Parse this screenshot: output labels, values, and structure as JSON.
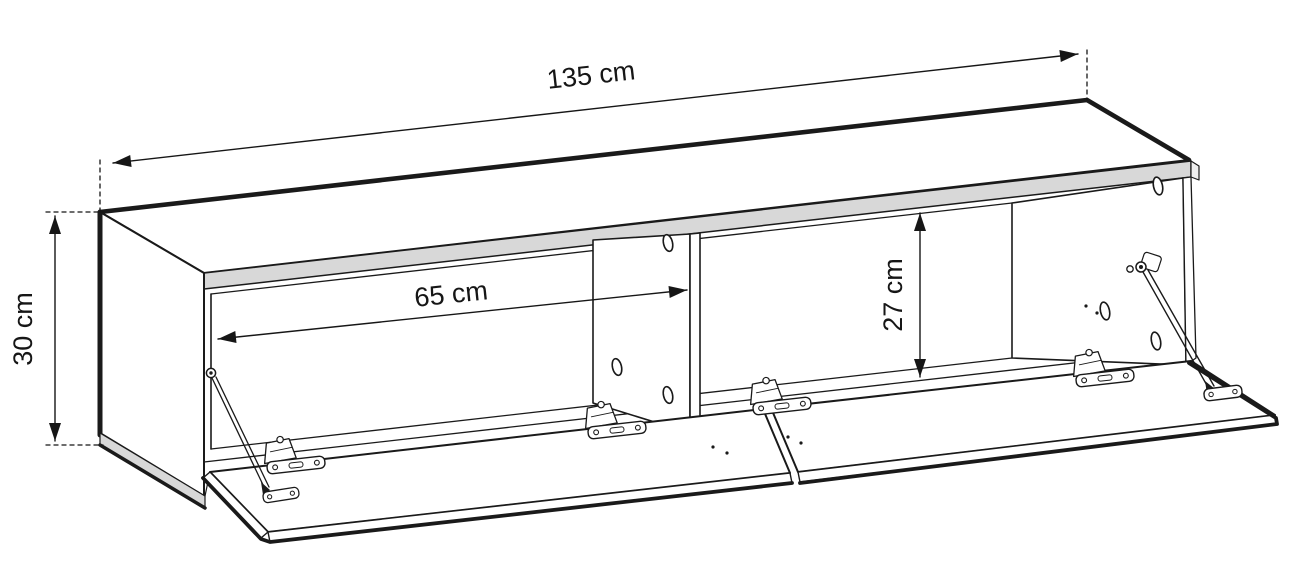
{
  "diagram": {
    "background_color": "#ffffff",
    "line_color": "#1a1a1a",
    "panel_edge_color": "#d8d8d8",
    "dimensions": {
      "overall_width": {
        "label": "135 cm",
        "value": 135,
        "unit": "cm"
      },
      "overall_height": {
        "label": "30 cm",
        "value": 30,
        "unit": "cm"
      },
      "compartment_width": {
        "label": "65 cm",
        "value": 65,
        "unit": "cm"
      },
      "compartment_height": {
        "label": "27 cm",
        "value": 27,
        "unit": "cm"
      }
    }
  }
}
